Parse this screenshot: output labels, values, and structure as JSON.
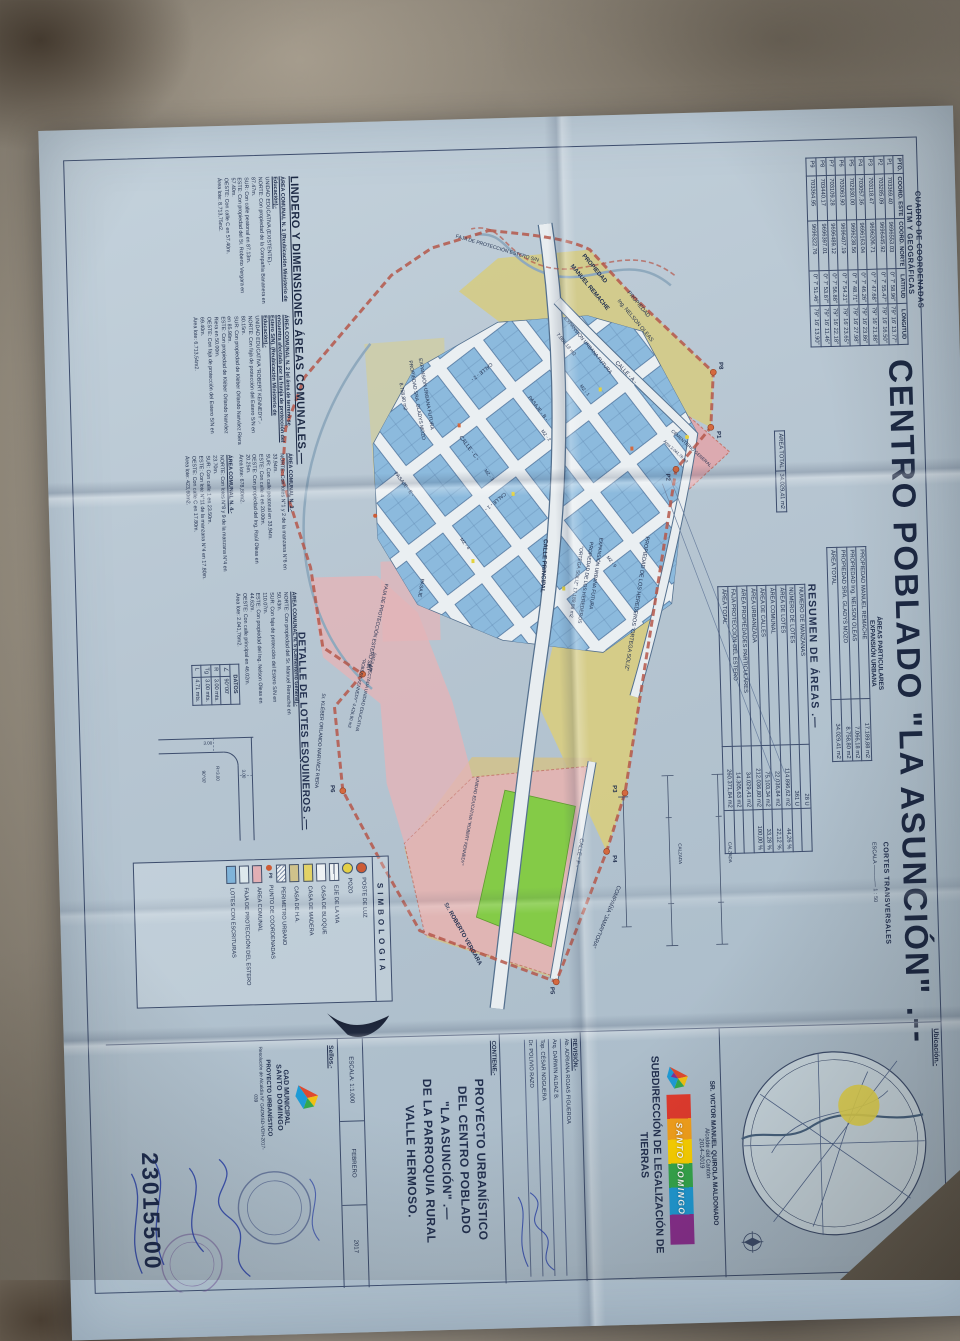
{
  "title": {
    "main": "CENTRO POBLADO \"LA ASUNCIÓN\" .--"
  },
  "coord_table": {
    "title1": "CUADRO DE COORDENADAS",
    "title2": "UTM Y GEOGRÁFICAS",
    "headers": [
      "PTO.",
      "COORD. ESTE",
      "COORD. NORTE",
      "LATITUD",
      "LONGITUD"
    ],
    "rows": [
      [
        "P1",
        "703369.40",
        "9696553.03",
        "0° 7' 58.96\"",
        "79° 16' 13.77\""
      ],
      [
        "P2",
        "703285.09",
        "9696445.92",
        "0° 7' 55.47\"",
        "79° 16' 16.50\""
      ],
      [
        "P3",
        "703118.47",
        "9696206.71",
        "0° 7' 47.68\"",
        "79° 16' 21.88\""
      ],
      [
        "P4",
        "703057.36",
        "9696163.04",
        "0° 7' 46.26\"",
        "79° 16' 23.86\""
      ],
      [
        "P5",
        "702930.00",
        "9696238.56",
        "0° 7' 48.71\"",
        "79° 16' 27.98\""
      ],
      [
        "P6",
        "703063.90",
        "9696407.19",
        "0° 7' 54.21\"",
        "79° 16' 23.65\""
      ],
      [
        "P7",
        "703109.28",
        "9696489.12",
        "0° 7' 56.88\"",
        "79° 16' 22.18\""
      ],
      [
        "P8",
        "703440.17",
        "9696397.01",
        "0° 7' 53.87\"",
        "79° 16' 11.46\""
      ],
      [
        "P9",
        "703364.95",
        "9696322.76",
        "0° 7' 51.46\"",
        "79° 16' 13.90\""
      ]
    ]
  },
  "areas_particulares": {
    "title1": "ÁREAS PARTICULARES",
    "title2": "EXPANSIÓN URBANA",
    "rows": [
      [
        "PROPIEDAD MANUEL REMACHE",
        "17.189,88 m2"
      ],
      [
        "PROPIEDAD Ing. NELSON OLEAS",
        "7.066,18 m2"
      ],
      [
        "PROPIEDAD SRA. GLADYS MOZO",
        "8.758,80 m2"
      ],
      [
        "ÁREA TOTAL",
        "34.029,41 m2"
      ]
    ]
  },
  "area_total_box": {
    "label": "ÁREA TOTAL",
    "value": "34.029,41 m2"
  },
  "resumen": {
    "title": "RESUMEN DE ÁREAS .—",
    "rows": [
      [
        "NÚMERO DE MANZANAS",
        "28 U",
        ""
      ],
      [
        "NÚMERO DE LOTES",
        "361 U",
        ""
      ],
      [
        "ÁREA DE LOTES",
        "114.896,62 m2",
        "44,26 %"
      ],
      [
        "ÁREA COMUNAL",
        "22.036,84 m2",
        "22,12 %"
      ],
      [
        "ÁREA DE CALLES",
        "75.103,34 m2",
        "33,28 %"
      ],
      [
        "ÁREA URBANIZADA",
        "212.036,80 m2",
        "100,00 %"
      ],
      [
        "ÁREA PROPIEDADES PARTICULARES",
        "34.029,41 m2",
        ""
      ],
      [
        "FAJA PROTECCIÓN DEL ESTERO",
        "14.305,63 m2",
        ""
      ],
      [
        "ÁREA TOTAL",
        "260.371,84 m2",
        ""
      ]
    ]
  },
  "lindero": {
    "heading": "LINDERO Y DIMENSIONES ÁREAS COMUNALES.—",
    "areas": [
      {
        "title": "ÁREA COMUNAL N. 1 (Reubicación Ministerio de Educación).-",
        "body": "UNIDAD EDUCATIVA (EXISTENTE).-\nNORTE: Con propiedad de la Compañía Bananera en 87.47m.\nSUR: Con calle peatonal en 87.13m.\nESTE: Con propiedad del Sr. Roberto Vergara en 57.40m.\nOESTE: Con calle C en 57.40m.\nÁrea lote: 8.713,75m2."
      },
      {
        "title": "ÁREA COMUNAL N. 2 (el área de terreno se encuentra afectada por la franja de protección del Estero S/N). (Reubicación Ministerio de Educación).-",
        "body": "UNIDAD EDUCATIVA \"ROBERT KENNEDY\".-\nNORTE: Con faja de protección del Estero S/N en 80.15m.\nSUR: Con propiedad de Kléber Orlando Narváez Riera en 85.98m.\nESTE: Con propiedad de Kléber Orlando Narváez Riera en 50.00m.\nOESTE: Con faja de protección del Estero S/N en 69.40m.\nÁrea lote: 6.713,54m2."
      },
      {
        "title": "ÁREA COMUNAL N. 3.-",
        "body": "NORTE: Con lotes N°1 y 2 de la manzana N°6 en 33.94m.\nSUR: Con calle peatonal en 33.94m.\nESTE: Con calle 4 en 20.00m.\nOESTE: Con propiedad del Ing. Raúl Oleas en 20.25m.\nÁrea lote: 678,80m2."
      },
      {
        "title": "ÁREA COMUNAL N. 4.-",
        "body": "NORTE: Con lotes N°8 y 9 de la manzana N°4 en 23.70m.\nSUR: Con calle 1 en 23.50m.\nESTE: Con lote N°11 de la manzana N°4 en 17.80m.\nOESTE: Con calle C en 17.80m.\nÁrea lote: 423,60m2."
      },
      {
        "title": "ÁREA COMUNAL N. 5 (Cementerio General).-",
        "body": "NORTE: Con propiedad del Sr. Manuel Remache en 50.43m.\nSUR: Con faja de protección del Estero S/N en 110.07m.\nESTE: Con propiedad del Ing. Nelson Oleas en 44.62m.\nOESTE: Con calle principal en 46.02m.\nÁrea lote: 2.041,76m2."
      }
    ]
  },
  "detalle": {
    "heading": "DETALLE DE LOTES ESQUINEROS .—",
    "datos_title": "DATOS",
    "datos_rows": [
      [
        "∠",
        "90°00'"
      ],
      [
        "R",
        "3.00 mts."
      ],
      [
        "Tg",
        "3.00 mts."
      ],
      [
        "L",
        "4.71 mts."
      ]
    ],
    "diagram": {
      "r": "R=3.00",
      "ang": "90°00'",
      "d1": "3.00",
      "d2": "3.00"
    }
  },
  "simbologia": {
    "title": "SIMBOLOGIA",
    "items": [
      {
        "sw": "dot-red",
        "sw_text": "",
        "label": "POSTE DE LUZ"
      },
      {
        "sw": "dot-yellow",
        "sw_text": "",
        "label": "POZO"
      },
      {
        "sw": "rect-eje",
        "sw_text": "",
        "label": "EJE DE LA VIA"
      },
      {
        "sw": "rect-white",
        "sw_text": "",
        "label": "CASA DE BLOQUE"
      },
      {
        "sw": "rect-yellow",
        "sw_text": "",
        "label": "CASA DE MADERA"
      },
      {
        "sw": "rect-khaki",
        "sw_text": "",
        "label": "CASA DE H.A."
      },
      {
        "sw": "rect-hatch",
        "sw_text": "",
        "label": "PERIMETRO URBANO"
      },
      {
        "sw": "p0",
        "sw_text": "P0",
        "label": "PUNTO DE COORDENADAS"
      },
      {
        "sw": "rect-pink",
        "sw_text": "",
        "label": "AREA COMUNAL"
      },
      {
        "sw": "rect-faja",
        "sw_text": "",
        "label": "FAJA DE PROTECCIÓN DEL ESTERO"
      },
      {
        "sw": "rect-blue",
        "sw_text": "",
        "label": "LOTES CON ESCRITURAS"
      }
    ]
  },
  "map": {
    "points": [
      "P1",
      "P2",
      "P3",
      "P4",
      "P5",
      "P6",
      "P7",
      "P8"
    ],
    "labels": {
      "calle_a": "CALLE - A -",
      "calle_2": "CALLE - 2 -",
      "calle_c": "CALLE - C -",
      "calle_1": "CALLE - 1 -",
      "pasaje_b": "PASAJE - B -",
      "pasaje_e": "PASAJE - E -",
      "pasaje": "PASAJE",
      "calle_f": "CALLE - F -",
      "principal": "CALLE PRINCIPAL",
      "remache1": "PROPIEDAD",
      "remache2": "MANUEL REMACHE",
      "oleas1": "PROPIEDAD",
      "oleas2": "Ing. NELSON OLEAS",
      "expansion1": "EXPANSIÓN URBANA FUTURA",
      "expansion2": "7.066,18 m2",
      "ortega_line": "PROPIEDAD DE LOS HEREDEROS \"ORTEGA SOLIZ\"",
      "ortega_b1": "EXPANSIÓN URBANA FUTURA",
      "ortega_b2": "PROPIEDAD DE LOS HEREDEROS",
      "ortega_b3": "\"ORTEGA SOLIZ\"  17.189,88 m2",
      "gladys1": "EXPANSIÓN URBANA FUTURA",
      "gladys2": "PROPIEDAD SRA. GLADYS MOZO",
      "gladys3": "8.758,80 m2",
      "cem1": "CEMENTERIO GENERAL",
      "cem2": "Área 2.041,76 m2",
      "faja": "FAJA DE PROTECCIÓN ESTERO S/N",
      "vergara": "Sr. ROBERTO VERGARA",
      "jamaytora": "COMPAÑÍA \"JAMAYTORA\"",
      "kleber": "Sr. KLÉBER ORLANDO NARVÁEZ RIERA",
      "afect1": "ÁREA AFECTADA UNIDAD EDUCATIVA",
      "afect2": "\"ROBERT KENNEDY\"  4.426,90 m2",
      "educativa": "UNIDAD EDUCATIVA \"ROBERT KENNEDY\"",
      "mz": [
        "MZ - 1",
        "MZ - 2",
        "MZ - 3",
        "MZ - 4",
        "MZ - 9"
      ],
      "cortes_title": "CORTES TRANSVERSALES",
      "cortes_esc": "ESCALA ———— 1 : 50",
      "calzada": "CALZADA"
    }
  },
  "title_block": {
    "ubicacion_label": "Ubicación.-",
    "alcalde_line1": "SR. VICTOR MANUEL QUIROLA MALDONADO",
    "alcalde_line2": "Alcalde del Cantón",
    "alcalde_line3": "2014–2019",
    "logo_text": "SANTO DOMINGO",
    "subdireccion": "SUBDIRECCIÓN DE LEGALIZACIÓN DE TIERRAS",
    "revision_label": "REVISIÓN.-",
    "revision_names": [
      "Ab. ADRIANA ROJAS FIGUEROA",
      "Arq. DARWIN ALDAZ B.",
      "Top. CÉSAR NOGUERA",
      "Dr. POLIVIO RAZO"
    ],
    "contiene_label": "CONTIENE.-",
    "contiene_text": "PROYECTO URBANÍSTICO\nDEL CENTRO POBLADO\n\"LA ASUNCIÓN\" .—\nDE LA PARROQUIA RURAL\nVALLE HERMOSO.",
    "escala": "ESCALA: 1:1.000",
    "fecha_mes": "FEBRERO",
    "fecha_anio": "2017",
    "sellos_label": "Sellos.-",
    "gad_line1": "GAD MUNICIPAL",
    "gad_line2": "SANTO DOMINGO",
    "gad_line3": "PROYECTO URBANÍSTICO",
    "gad_line4": "Resolución de Alcaldía N° GADMSD-VDH-2017-039",
    "film_number": "23015500"
  }
}
